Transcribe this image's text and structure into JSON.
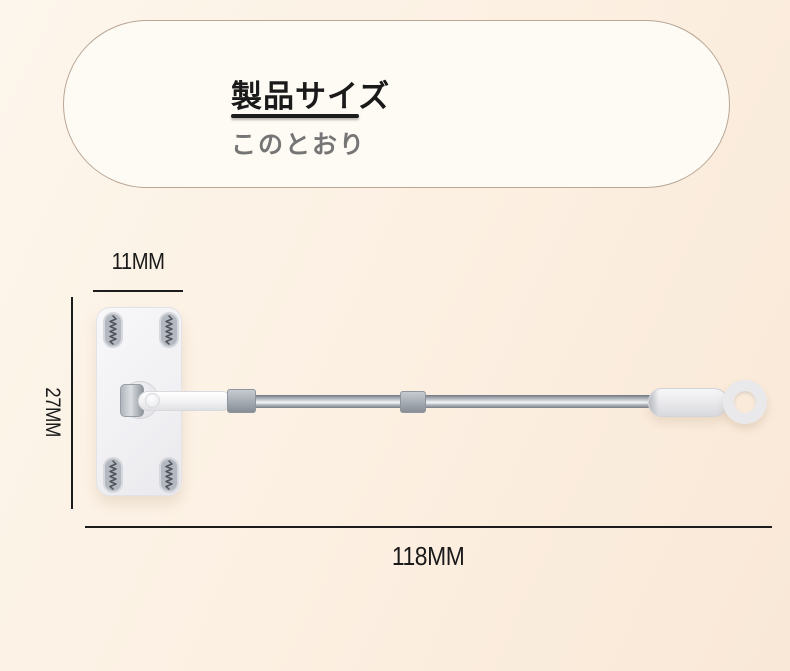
{
  "palette": {
    "bg-top": "#fdf6ec",
    "bg-bottom": "#f9e8d7",
    "card-bg": "#fdfbf4",
    "card-border": "#b9a796",
    "title-color": "#1a1a1a",
    "subtitle-color": "#757575",
    "line-color": "#1c1c1c",
    "head-bg": "#f1f1f4",
    "pad-bg": "#b4b8c0",
    "metal-dark": "#6e757d",
    "metal-light": "#f7f9fa"
  },
  "header_card": {
    "title": "製品サイズ",
    "subtitle": "このとおり"
  },
  "dimension_labels": {
    "head_width": "11MM",
    "head_height": "27MM",
    "total_length": "118MM"
  }
}
